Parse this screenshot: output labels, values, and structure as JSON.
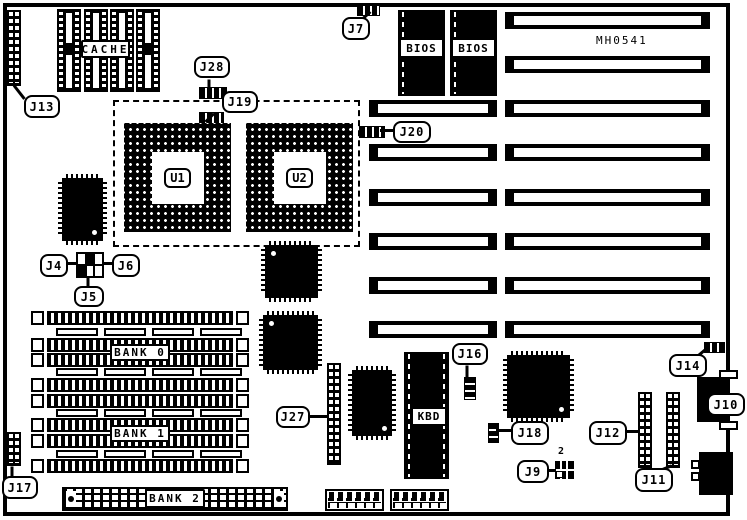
{
  "diagram": {
    "board_model": "MH0541",
    "chips": {
      "cache": "CACHE",
      "bios_left": "BIOS",
      "bios_right": "BIOS",
      "keyboard_controller": "KBD",
      "cpu_socket_1": "U1",
      "cpu_socket_2": "U2"
    },
    "memory_banks": {
      "bank0": "BANK 0",
      "bank1": "BANK 1",
      "bank2": "BANK 2"
    },
    "jumper_labels": {
      "j4": "J4",
      "j5": "J5",
      "j6": "J6",
      "j7": "J7",
      "j9": "J9",
      "j10": "J10",
      "j11": "J11",
      "j12": "J12",
      "j13": "J13",
      "j14": "J14",
      "j16": "J16",
      "j17": "J17",
      "j18": "J18",
      "j19": "J19",
      "j20": "J20",
      "j27": "J27",
      "j28": "J28"
    },
    "annotations": {
      "j9_pin2": "2"
    },
    "colors": {
      "ink": "#000000",
      "paper": "#ffffff"
    }
  }
}
